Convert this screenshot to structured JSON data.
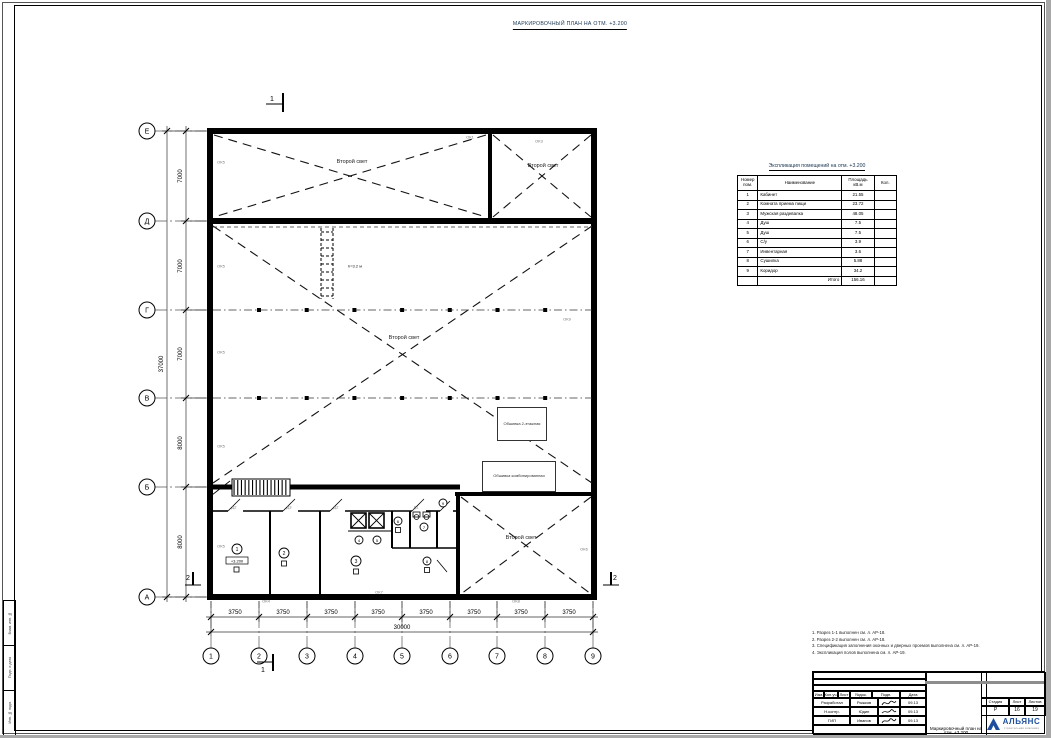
{
  "sheet": {
    "title": "МАРКИРОВОЧНЫЙ ПЛАН НА ОТМ. +3.200"
  },
  "plan": {
    "second_light_label": "Второй свет",
    "ladder_height": "h=3.2 м",
    "elevation_mark": "+3.200",
    "callouts": [
      "Обшивка 2-этажная",
      "Обшивка комбинированная"
    ],
    "section_marks": {
      "one": "1",
      "two": "2"
    },
    "window_labels": {
      "ok1": "ОК1",
      "ok3": "ОК3",
      "ok4": "ОК4",
      "ok5": "ОК5",
      "ok6": "ОК6",
      "ok7": "ОК7",
      "ok8": "ОК8",
      "ok9": "ОК9"
    },
    "door_labels": {
      "d1": "Д1",
      "d2": "Д2",
      "d3": "Д3"
    },
    "room_numbers": [
      "1",
      "2",
      "3",
      "4",
      "5",
      "6",
      "7",
      "8",
      "9"
    ]
  },
  "axes": {
    "rows": [
      "Е",
      "Д",
      "Г",
      "В",
      "Б",
      "А"
    ],
    "cols": [
      "1",
      "2",
      "3",
      "4",
      "5",
      "6",
      "7",
      "8",
      "9"
    ]
  },
  "dimensions": {
    "bottom_segments": [
      "3750",
      "3750",
      "3750",
      "3750",
      "3750",
      "3750",
      "3750",
      "3750"
    ],
    "bottom_total": "30000",
    "left_segments": [
      "7000",
      "7000",
      "7000",
      "8000",
      "8000"
    ],
    "left_total": "37000"
  },
  "explication": {
    "title": "Экспликация помещений на отм. +3.200",
    "headers": {
      "num": "Номер пом.",
      "name": "Наименование",
      "area": "Площадь кВ.м",
      "qty": "Кол."
    },
    "rows": [
      {
        "num": "1",
        "name": "Кабинет",
        "area": "21.55",
        "qty": ""
      },
      {
        "num": "2",
        "name": "Комната приема пищи",
        "area": "23.72",
        "qty": ""
      },
      {
        "num": "3",
        "name": "Мужская раздевалка",
        "area": "48.05",
        "qty": ""
      },
      {
        "num": "4",
        "name": "Душ",
        "area": "7.5",
        "qty": ""
      },
      {
        "num": "5",
        "name": "Душ",
        "area": "7.5",
        "qty": ""
      },
      {
        "num": "6",
        "name": "С/у",
        "area": "3.9",
        "qty": ""
      },
      {
        "num": "7",
        "name": "Инвентарная",
        "area": "3.6",
        "qty": ""
      },
      {
        "num": "8",
        "name": "Сушилка",
        "area": "5.88",
        "qty": ""
      },
      {
        "num": "9",
        "name": "Коридор",
        "area": "34.2",
        "qty": ""
      }
    ],
    "total_label": "Итого",
    "total_value": "156.16"
  },
  "notes": {
    "lines": [
      "1. Разрез 1-1 выполнен см. л. АР-18.",
      "2. Разрез 2-2 выполнен см. л. АР-18.",
      "3. Спецификация заполнения оконных и дверных проемов выполнена см. л. АР-19.",
      "4. Экспликация полов выполнена см. л. АР-19."
    ]
  },
  "titleblock": {
    "header_cells": [
      "Изм.",
      "Кол.уч.",
      "Лист",
      "№док.",
      "Подп.",
      "Дата"
    ],
    "sign_rows": [
      {
        "role": "Разработал",
        "name": "Рыжков",
        "date": "09.13"
      },
      {
        "role": "Н.контр.",
        "name": "Юдин",
        "date": "09.13"
      },
      {
        "role": "ГИП",
        "name": "Иванов",
        "date": "09.13"
      }
    ],
    "doc_title": "Маркировочный план на отм. +3.200",
    "stage_header": {
      "stage": "Стадия",
      "sheet": "Лист",
      "sheets": "Листов"
    },
    "stage_values": {
      "stage": "Р",
      "sheet": "16",
      "sheets": "19"
    },
    "logo": {
      "name": "АЛЬЯНС",
      "subtitle": "строительная компания",
      "color": "#1d4f9e"
    }
  },
  "side_strip": {
    "labels": [
      "Взам. инв. №",
      "Подп. и дата",
      "Инв. № подл."
    ]
  }
}
